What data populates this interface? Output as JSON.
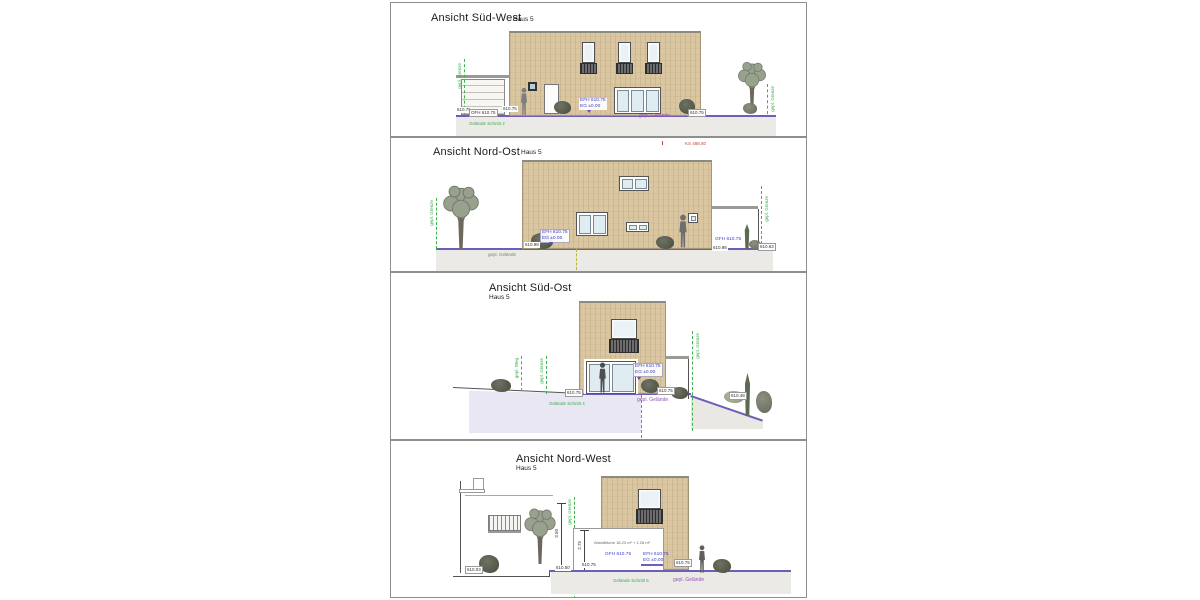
{
  "document": {
    "sheet": "Ansichten",
    "house": "Haus 5"
  },
  "colors": {
    "facade": "#dac7a2",
    "ground_line": "#6e5eb8",
    "annotation_blue": "#3f3fc6",
    "annotation_purple": "#9553b5",
    "annotation_green": "#3aae4a",
    "annotation_red": "#cc4433",
    "terrain_fill": "#e9e7f4"
  },
  "panels": [
    {
      "title": "Ansicht Süd-West",
      "subtitle": "Haus 5",
      "labels": {
        "lvl_a": "610.75",
        "ofh": "OFH 610.75",
        "lvl_b": "610.75",
        "efh": "EFH 610.75",
        "eg": "EG ±0.00",
        "lvl_c": "610.75",
        "gelaende": "gepl. Gelände",
        "schnitt": "Gelände Schnitt 2",
        "grenze_l": "gepl. Grenze",
        "grenze_r": "gepl. Grenze"
      }
    },
    {
      "title": "Ansicht Nord-Ost",
      "subtitle": "Haus 5",
      "ks": "KS 488.50",
      "labels": {
        "efh": "EFH 610.75",
        "eg": "EG ±0.00",
        "gfh": "GFH 610.75",
        "lvl_a": "610.98",
        "lvl_b": "610.98",
        "lvl_c": "610.63",
        "gelaende": "gepl. Gelände",
        "grenze_l": "gepl. Grenze",
        "grenze_r": "gepl. Grenze"
      }
    },
    {
      "title": "Ansicht Süd-Ost",
      "subtitle": "Haus 5",
      "labels": {
        "efh": "EFH 610.75",
        "eg": "EG ±0.00",
        "lvl_a": "610.75",
        "lvl_b": "610.75",
        "lvl_c": "610.48",
        "schnitt": "Gelände Schnitt 4",
        "gelaende": "gepl. Gelände",
        "weg": "gepl. Weg",
        "grenze_m": "gepl. Grenze",
        "grenze_r": "gepl. Grenze"
      }
    },
    {
      "title": "Ansicht Nord-West",
      "subtitle": "Haus 5",
      "labels": {
        "wand": "Wandfläche 18.23 m² + 1.26 m²",
        "gfh": "GFH 610.75",
        "efh": "EFH 610.75",
        "eg": "EG ±0.00",
        "dim_a": "3.50",
        "dim_b": "2.75",
        "lvl_a": "610.03",
        "lvl_b": "610.50",
        "lvl_c": "610.75",
        "lvl_d": "610.75",
        "schnitt": "Gelände Schnitt 5",
        "gelaende": "gepl. Gelände",
        "grenze": "gepl. Grenze"
      }
    }
  ]
}
